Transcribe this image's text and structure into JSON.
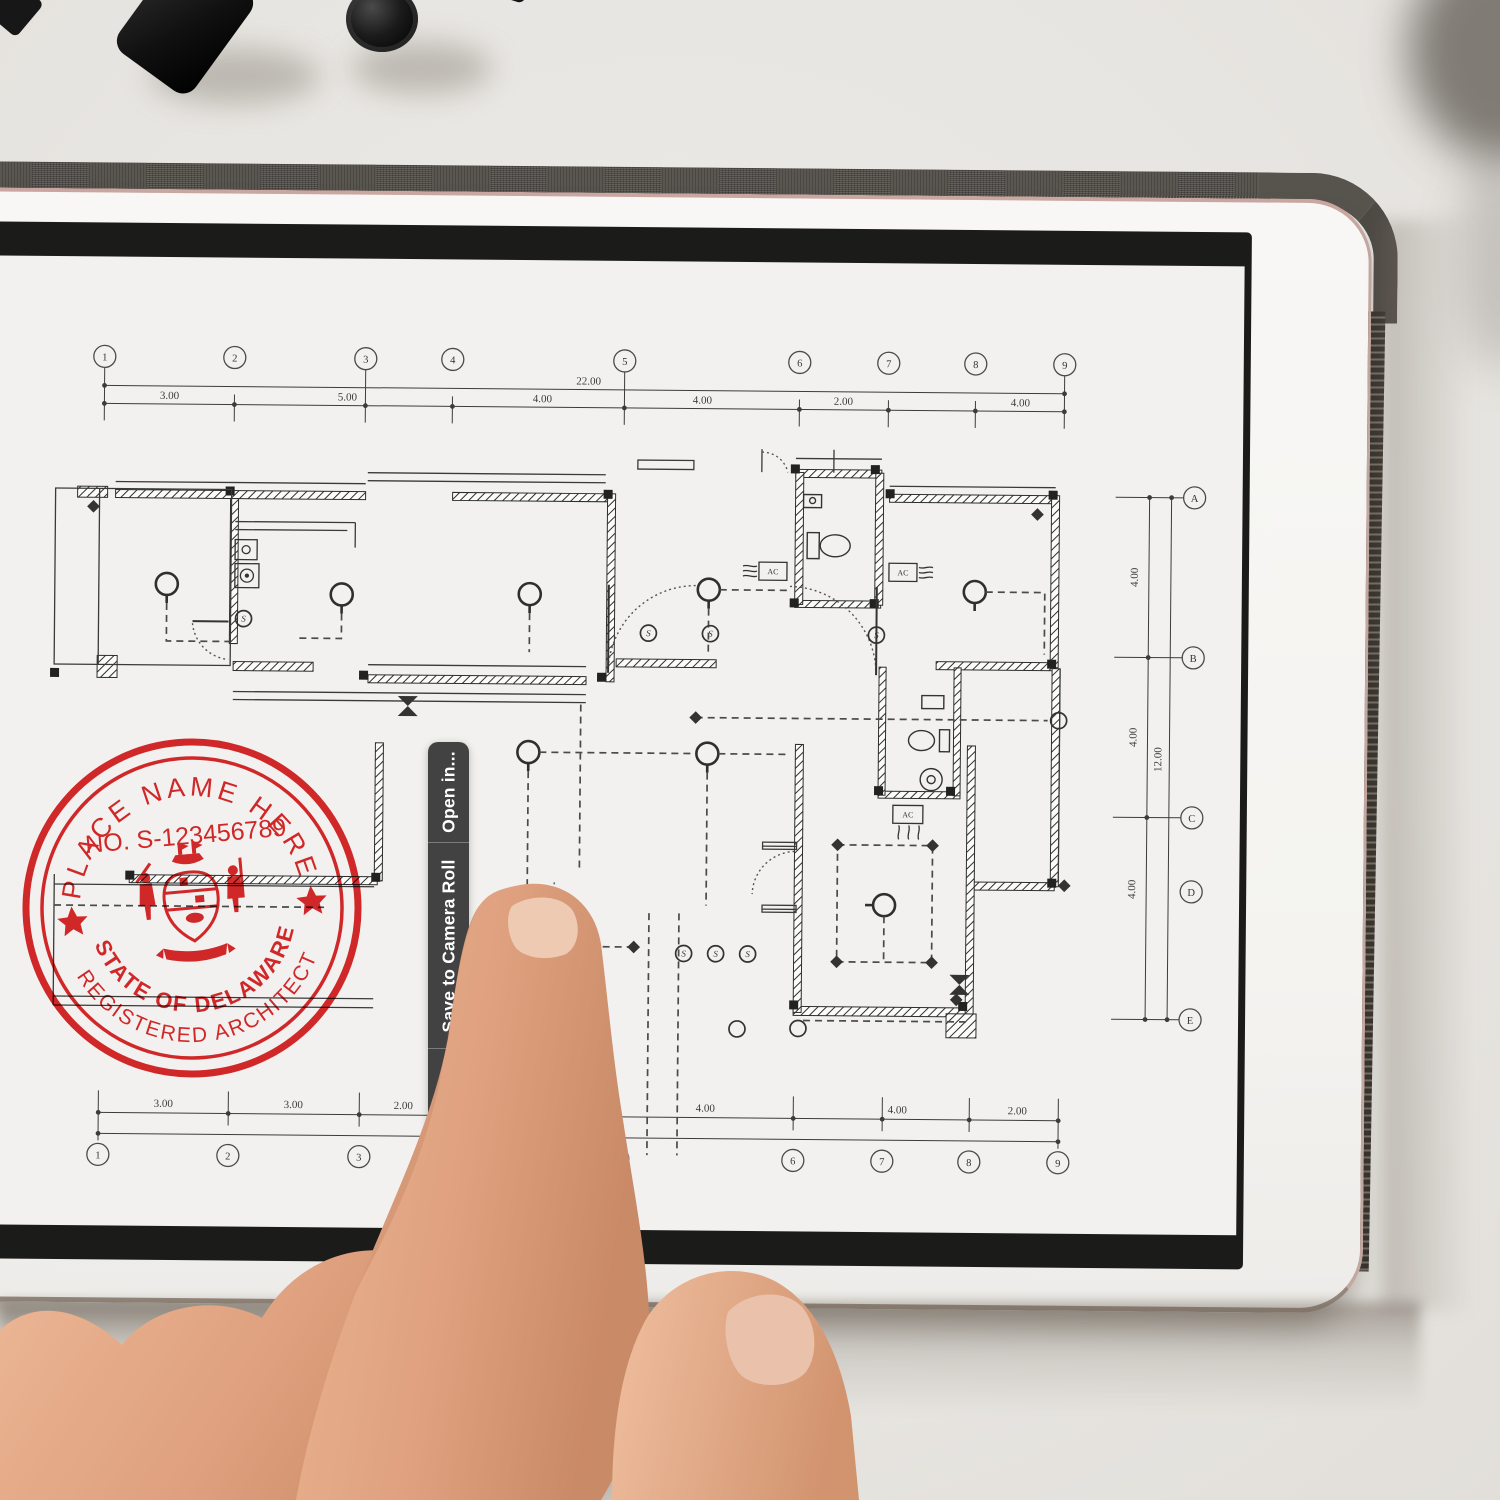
{
  "menu": {
    "items": [
      "Open in...",
      "Save to Camera Roll",
      "Copy"
    ]
  },
  "stamp": {
    "top_text": "PLACE NAME HERE",
    "number": "NO. S-123456789",
    "state": "STATE OF DELAWARE",
    "title": "REGISTERED  ARCHITECT",
    "color": "#d91e1e"
  },
  "plan": {
    "grid_cols": [
      "1",
      "2",
      "3",
      "4",
      "5",
      "6",
      "7",
      "8",
      "9"
    ],
    "grid_rows": [
      "A",
      "B",
      "C",
      "D",
      "E"
    ],
    "dims_top": [
      "3.00",
      "5.00",
      "4.00",
      "4.00",
      "2.00",
      "4.00"
    ],
    "dims_top_total": "22.00",
    "dims_bottom": [
      "3.00",
      "3.00",
      "2.00",
      "4.00",
      "4.00",
      "2.00"
    ],
    "dims_bottom_total": "22.00",
    "dims_right": [
      "4.00",
      "4.00",
      "4.00"
    ],
    "dims_right_total": "12.00",
    "ac_label": "AC"
  }
}
